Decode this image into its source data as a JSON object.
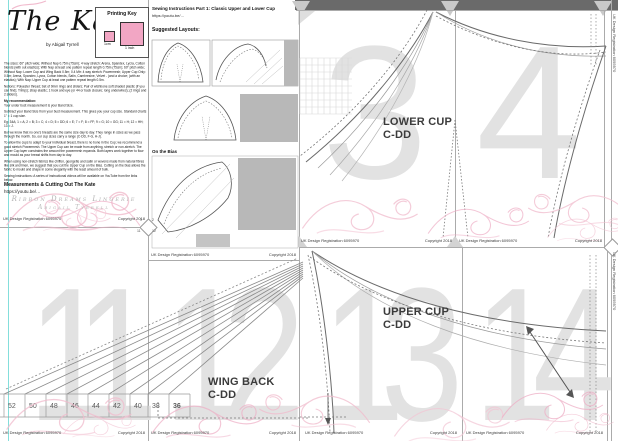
{
  "title_page": {
    "title": "The Kate",
    "byline": "by Abigail Tyrrell",
    "printing_key": {
      "heading": "Printing Key",
      "small_label": "1cm",
      "large_label": "1 inch"
    },
    "body_paragraphs": [
      "The sizes: 60\" pitch wide; Without Nap 0.75m (75cm); 4 way stretch: Arena, Spandex, Lycra, Cotton blends (with out elastics); With Nap at least one pattern repeat length 0.75m (75cm); 60\" pitch wide; Without Nap: Lower Cup and Wing Back 0.5m; 0.4 Mtr: 4 way stretch: Powermesh; Upper Cup Only: 0.5m; Arena, Spandex, Lycra, Cotton blends, Satin, Cambresine, Velvet - (and a choice; (with an elastics); With Nap: Upper Cup at least one pattern repeat length 0.5m.",
      "Notions: Polyester thread; Set of 9mm rings and sliders; Pair of wishbone soft shaded plastic (if you can find); Trim(s); strap elastic; 1 hook and eye (or 44 or back closure; long underwires); (2 rings and 2 sliders).",
      "My recommendation:",
      "Your under bust measurement is your Band Size.",
      "Subtract your Band Size from your bust measurement. This gives you your cup size. Standard charts 1\" = 1 cup size.",
      "Eg: 34A; 1 = A; 2 = B; 3 = C; 4 = D; 5 = DD; 6 = E; 7 = F; 8 = FF; 9 = G; 10 = GG; 11 = H; 12 = HH; 13 = J.",
      "But we know that no one's breasts are the same size day to day. They range in sizes as we pass through the month. So, our cup sizes carry a range (C-DD, F-G, H-J).",
      "To allow the cups to adapt to your individual breast, there is no bone in the Cup; we recommend a good stretch Powermesh. The Upper Cup can be made from anything, stretch or non-stretch. The Upper Cup layer constrains the amount the powermesh expands. Both layers work together to flow and mould as your breast shifts from day to day.",
      "When using non-stretch fabrics like chiffon, georgette and satin or wovens made from natural fibres like silk and linen, we suggest that you cut the Upper Cup on the Bias. Cutting on the bias allows the fabric to mould and shape in some elegantly with the least amount of bulk.",
      "Sewing Instructions: A series of instructional videos will be available on YouTube from the links below."
    ],
    "section_heading": "Measurements & Cutting Out The Kate",
    "link": "https://youtu.be/…",
    "brand_line1": "Ribbon Dreams Lingerie",
    "brand_line2": "Abigail Tyrrell"
  },
  "instructions_page": {
    "heading": "Sewing Instructions Part 1: Classic Upper and Lower Cup",
    "link": "https://youtu.be/…",
    "layouts_heading": "Suggested Layouts:",
    "bias_label": "On the Bias"
  },
  "page_numbers": {
    "p3": "3",
    "p4": "4",
    "p11": "11",
    "p12": "12",
    "p13": "13",
    "p14": "14"
  },
  "pieces": {
    "lower_cup": {
      "line1": "LOWER CUP",
      "line2": "C-DD"
    },
    "upper_cup": {
      "line1": "UPPER CUP",
      "line2": "C-DD"
    },
    "wing_back": {
      "line1": "WING BACK",
      "line2": "C-DD"
    },
    "sizes": [
      "52",
      "50",
      "48",
      "46",
      "44",
      "42",
      "40",
      "38",
      "36"
    ]
  },
  "corner_marker": {
    "p1": "1",
    "p2": "2",
    "p11": "11",
    "p12": "12"
  },
  "footer": {
    "left": "UK Design Registration 6095970",
    "right": "Copyright 2018"
  },
  "colors": {
    "accent_pink": "#f2a6c4",
    "flourish_pink": "#f1bccd",
    "guide_cyan": "#6fd8d5",
    "ghost_numeral": "#e2e2e2",
    "edge_bar": "#6a6a6a"
  }
}
